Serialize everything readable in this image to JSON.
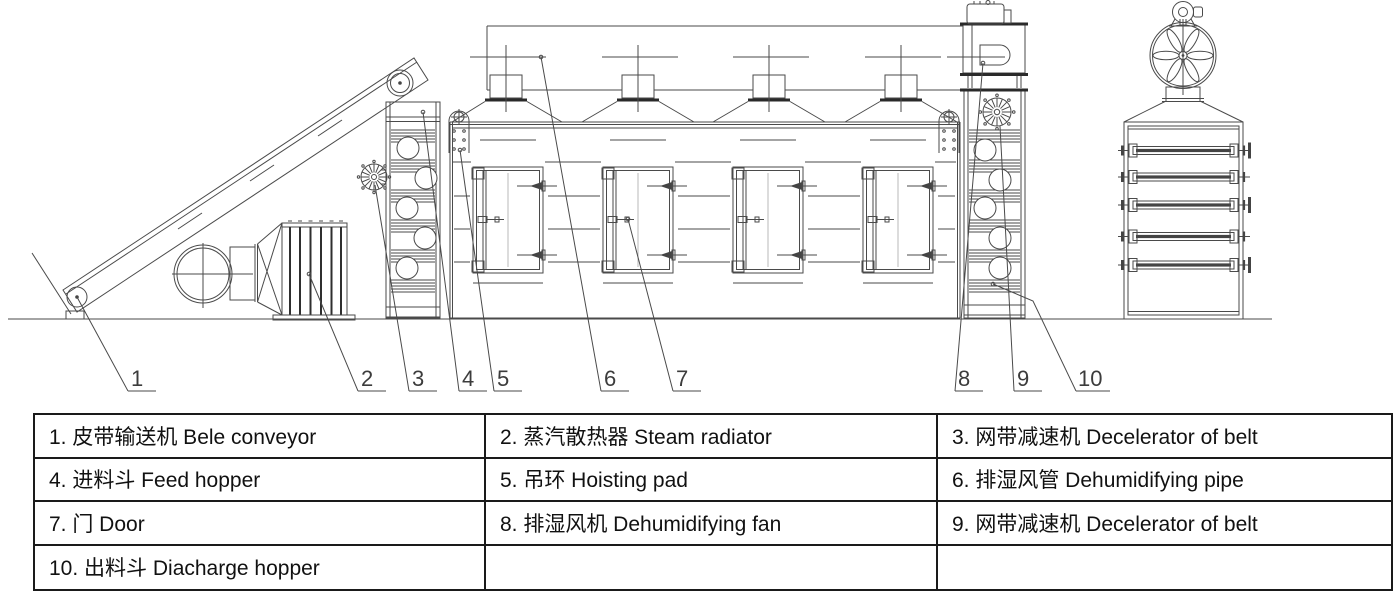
{
  "figure": {
    "type": "engineering-diagram",
    "subject_en": "Mesh belt dryer side view and end view with numbered part callouts"
  },
  "colors": {
    "background": "#ffffff",
    "line": "#4a4a4a",
    "dark_line": "#2a2a2a",
    "table_border": "#1a1a1a"
  },
  "callouts": [
    "1",
    "2",
    "3",
    "4",
    "5",
    "6",
    "7",
    "8",
    "9",
    "10"
  ],
  "parts": [
    {
      "num": "1",
      "zh": "皮带输送机",
      "en": "Bele conveyor"
    },
    {
      "num": "2",
      "zh": "蒸汽散热器",
      "en": "Steam radiator"
    },
    {
      "num": "3",
      "zh": "网带减速机",
      "en": "Decelerator of belt"
    },
    {
      "num": "4",
      "zh": "进料斗",
      "en": "Feed hopper"
    },
    {
      "num": "5",
      "zh": "吊环",
      "en": "Hoisting pad"
    },
    {
      "num": "6",
      "zh": "排湿风管",
      "en": "Dehumidifying pipe"
    },
    {
      "num": "7",
      "zh": "门",
      "en": "Door"
    },
    {
      "num": "8",
      "zh": "排湿风机",
      "en": "Dehumidifying fan"
    },
    {
      "num": "9",
      "zh": "网带减速机",
      "en": "Decelerator of belt"
    },
    {
      "num": "10",
      "zh": "出料斗",
      "en": "Diacharge hopper"
    }
  ],
  "legend": {
    "rows": [
      [
        "1. 皮带输送机 Bele conveyor",
        "2. 蒸汽散热器 Steam radiator",
        "3. 网带减速机 Decelerator of belt"
      ],
      [
        "4. 进料斗 Feed hopper",
        "5. 吊环 Hoisting pad",
        "6. 排湿风管 Dehumidifying pipe"
      ],
      [
        "7. 门 Door",
        "8. 排湿风机 Dehumidifying fan",
        "9. 网带减速机 Decelerator of belt"
      ],
      [
        "10. 出料斗 Diacharge hopper",
        "",
        ""
      ]
    ]
  }
}
